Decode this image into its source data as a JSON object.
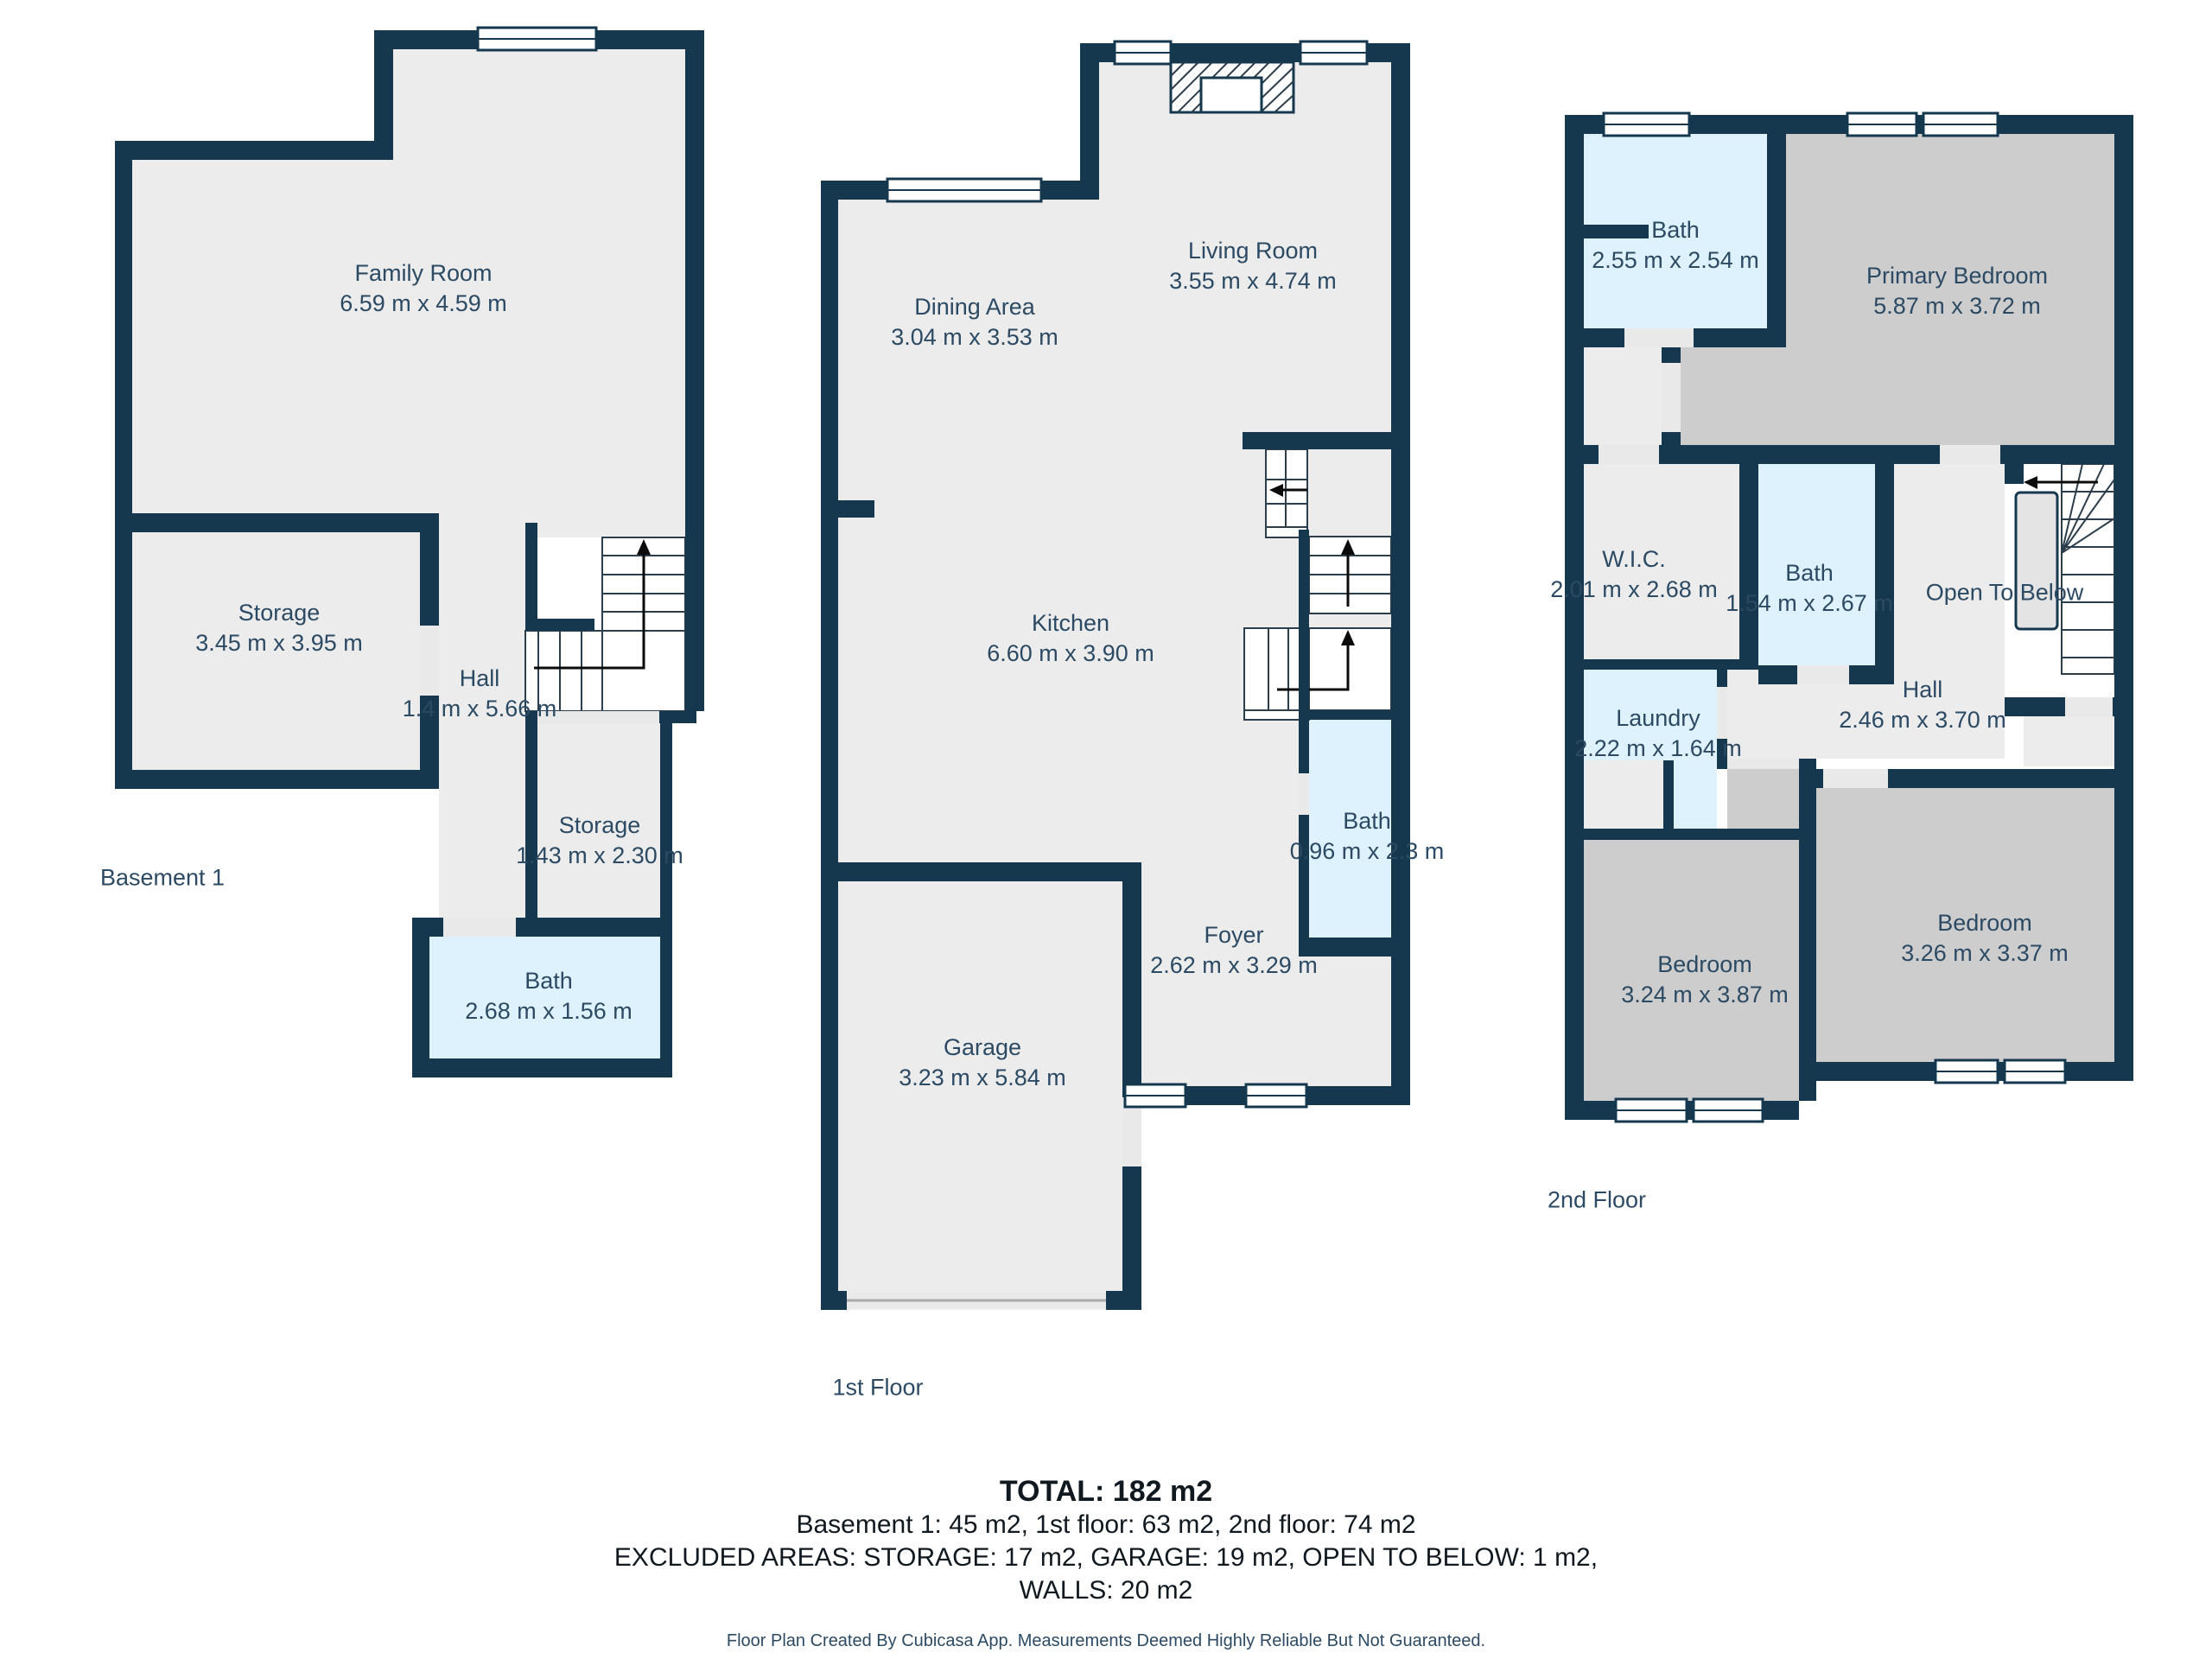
{
  "colors": {
    "wall": "#16384E",
    "room": "#ECECEC",
    "wet": "#DDF2FC",
    "bed": "#CDCDCD",
    "th": "#E9E9E9",
    "label": "#2C4A63",
    "summary": "#101820",
    "disc": "#2C4A63",
    "bg": "#FFFFFF"
  },
  "floors": {
    "basement": {
      "title": "Basement 1",
      "rooms": {
        "family": {
          "label": "Family Room",
          "dims": "6.59 m x 4.59 m"
        },
        "storage": {
          "label": "Storage",
          "dims": "3.45 m x 3.95 m"
        },
        "hall": {
          "label": "Hall",
          "dims": "1.4 m x 5.66 m"
        },
        "storage2": {
          "label": "Storage",
          "dims": "1.43 m x 2.30 m"
        },
        "bath": {
          "label": "Bath",
          "dims": "2.68 m x 1.56 m"
        }
      }
    },
    "first": {
      "title": "1st Floor",
      "rooms": {
        "living": {
          "label": "Living Room",
          "dims": "3.55 m x 4.74 m"
        },
        "dining": {
          "label": "Dining Area",
          "dims": "3.04 m x 3.53 m"
        },
        "kitchen": {
          "label": "Kitchen",
          "dims": "6.60 m x 3.90 m"
        },
        "bath": {
          "label": "Bath",
          "dims": "0.96 m x 2.3 m"
        },
        "foyer": {
          "label": "Foyer",
          "dims": "2.62 m x 3.29 m"
        },
        "garage": {
          "label": "Garage",
          "dims": "3.23 m x 5.84 m"
        }
      }
    },
    "second": {
      "title": "2nd Floor",
      "rooms": {
        "bath": {
          "label": "Bath",
          "dims": "2.55 m x 2.54 m"
        },
        "primary": {
          "label": "Primary Bedroom",
          "dims": "5.87 m x 3.72 m"
        },
        "wic": {
          "label": "W.I.C.",
          "dims": "2.01 m x 2.68 m"
        },
        "bath2": {
          "label": "Bath",
          "dims": "1.54 m x 2.67 m"
        },
        "open_to_below": {
          "label": "Open To Below",
          "dims": ""
        },
        "laundry": {
          "label": "Laundry",
          "dims": "2.22 m x 1.64 m"
        },
        "hall": {
          "label": "Hall",
          "dims": "2.46 m x 3.70 m"
        },
        "bedroom_left": {
          "label": "Bedroom",
          "dims": "3.24 m x 3.87 m"
        },
        "bedroom_right": {
          "label": "Bedroom",
          "dims": "3.26 m x 3.37 m"
        }
      }
    }
  },
  "summary": {
    "total": "TOTAL: 182 m2",
    "per_floor": "Basement 1: 45 m2, 1st floor: 63 m2, 2nd floor: 74 m2",
    "excluded": "EXCLUDED AREAS: STORAGE: 17 m2, GARAGE: 19 m2, OPEN TO BELOW: 1 m2,",
    "walls": "WALLS: 20 m2",
    "disclaimer": "Floor Plan Created By Cubicasa App. Measurements Deemed Highly Reliable But Not Guaranteed."
  }
}
